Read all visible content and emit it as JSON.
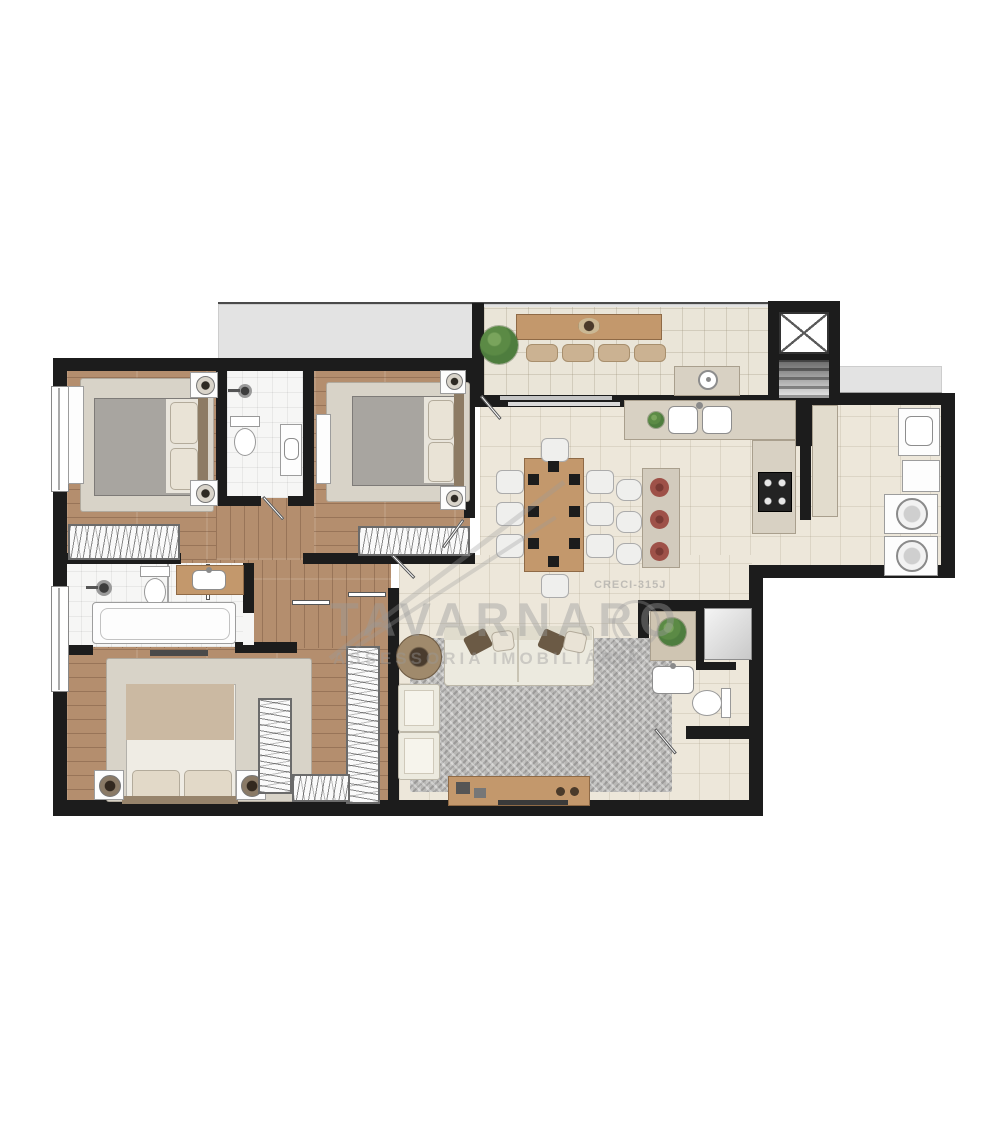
{
  "watermark": {
    "brand": "TAVARNARO",
    "tagline": "ASSESSORIA IMOBILIÁRIA",
    "license": "CRECI-315J"
  },
  "colors": {
    "wall": "#1c1c1c",
    "wood_floor": "#b48e6e",
    "tile_floor": "#ede7da",
    "bath_floor": "#f6f6f5",
    "balcony_floor": "#eae5d8",
    "common_area": "#e3e3e3",
    "wood_furniture": "#c3986c",
    "rug_bedroom": "#d8d3c8",
    "rug_living": "#b9b8b6",
    "plant": "#4e7d3e",
    "placemat": "#9e5148",
    "blanket_gray": "#a8a5a0",
    "blanket_tan": "#cbb9a2",
    "watermark": "#9a9a9a"
  }
}
